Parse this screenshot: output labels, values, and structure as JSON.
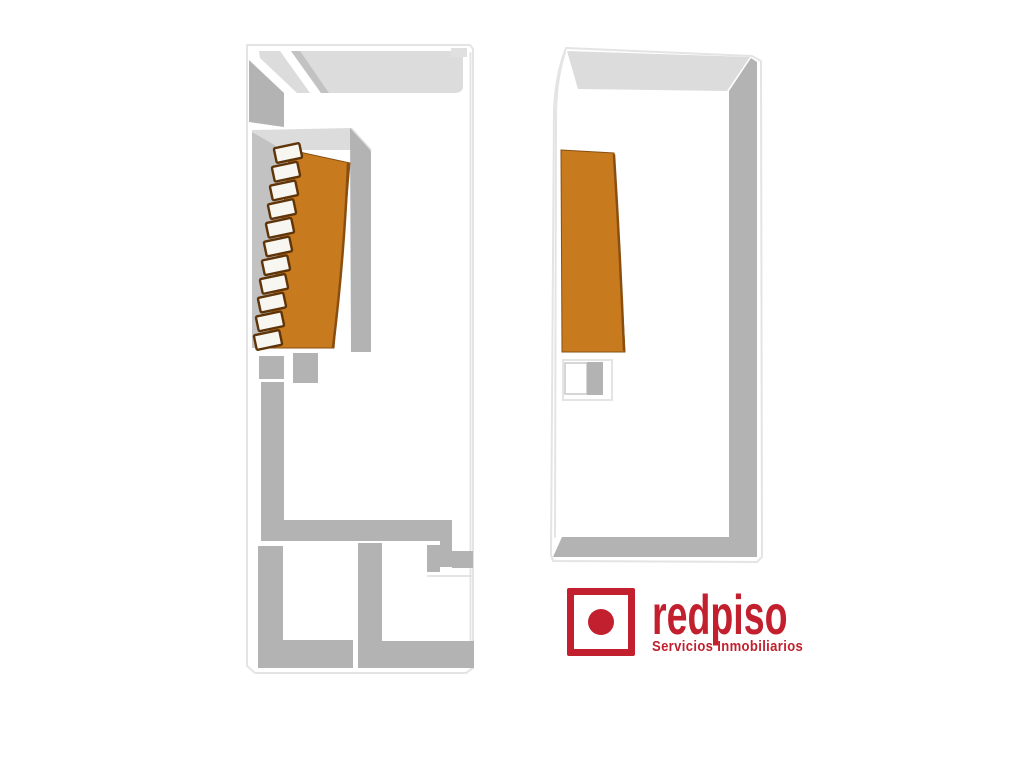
{
  "canvas": {
    "width": 1024,
    "height": 768,
    "background": "#ffffff"
  },
  "colors": {
    "wall_light": "#dcdcdc",
    "wall_mid": "#b3b3b3",
    "wall_soft": "#c2c2c2",
    "outline": "#e4e4e4",
    "terrace_orange": "#c87a1e",
    "terrace_edge": "#8a4f10",
    "stair_outline": "#5e3408",
    "brand_red": "#c2202e"
  },
  "logo": {
    "brand": "redpiso",
    "tagline": "Servicios Inmobiliarios"
  }
}
